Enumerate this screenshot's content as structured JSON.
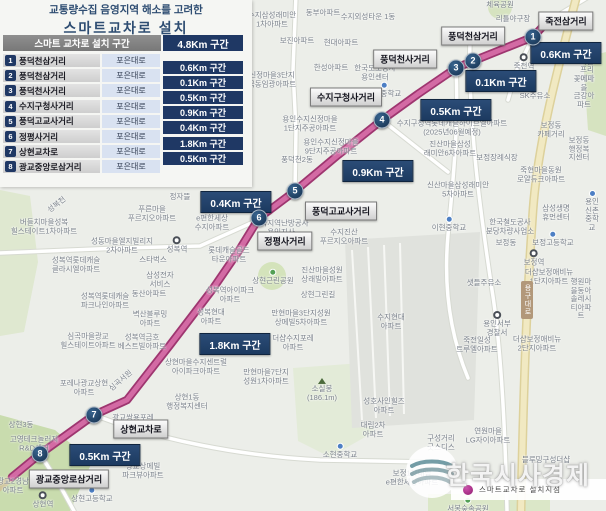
{
  "title": {
    "line1": "교통량수집 음영지역 해소를 고려한",
    "line2": "스마트교차로  설치"
  },
  "table": {
    "header": {
      "label": "스마트 교차로 설치 구간",
      "total": "4.8Km 구간"
    },
    "rows": [
      {
        "no": "1",
        "name": "풍덕천삼거리",
        "road": "포은대로"
      },
      {
        "no": "2",
        "name": "풍덕천삼거리",
        "road": "포은대로"
      },
      {
        "no": "3",
        "name": "풍덕천사거리",
        "road": "포은대로"
      },
      {
        "no": "4",
        "name": "수지구청사거리",
        "road": "포은대로"
      },
      {
        "no": "5",
        "name": "풍덕고교사거리",
        "road": "포은대로"
      },
      {
        "no": "6",
        "name": "정평사거리",
        "road": "포은대로"
      },
      {
        "no": "7",
        "name": "상현교차로",
        "road": "포은대로"
      },
      {
        "no": "8",
        "name": "광교중앙로삼거리",
        "road": "포은대로"
      }
    ],
    "segments": [
      "0.6Km 구간",
      "0.1Km 구간",
      "0.5Km 구간",
      "0.9Km 구간",
      "0.4Km 구간",
      "1.8Km 구간",
      "0.5Km 구간"
    ]
  },
  "map": {
    "route_points": "548,21 533,37 473,61 456,68 418,94 382,120 338,155 295,191 259,218 238,252 212,290 170,345 127,400 94,415 40,454 12,477",
    "markers": [
      {
        "no": "1",
        "x": 533,
        "y": 37
      },
      {
        "no": "2",
        "x": 473,
        "y": 61
      },
      {
        "no": "3",
        "x": 456,
        "y": 68
      },
      {
        "no": "4",
        "x": 382,
        "y": 120
      },
      {
        "no": "5",
        "x": 295,
        "y": 191
      },
      {
        "no": "6",
        "x": 259,
        "y": 218
      },
      {
        "no": "7",
        "x": 94,
        "y": 415
      },
      {
        "no": "8",
        "x": 40,
        "y": 454
      }
    ],
    "intersections": [
      {
        "text": "죽전삼거리",
        "x": 566,
        "y": 21
      },
      {
        "text": "풍덕천삼거리",
        "x": 473,
        "y": 36
      },
      {
        "text": "풍덕천사거리",
        "x": 405,
        "y": 59
      },
      {
        "text": "수지구청사거리",
        "x": 346,
        "y": 97
      },
      {
        "text": "풍덕고교사거리",
        "x": 341,
        "y": 211
      },
      {
        "text": "정평사거리",
        "x": 285,
        "y": 241
      },
      {
        "text": "상현교차로",
        "x": 141,
        "y": 429
      },
      {
        "text": "광교중앙로삼거리",
        "x": 69,
        "y": 479
      }
    ],
    "distance_badges": [
      {
        "text": "0.6Km 구간",
        "x": 566,
        "y": 53
      },
      {
        "text": "0.1Km 구간",
        "x": 501,
        "y": 81
      },
      {
        "text": "0.5Km 구간",
        "x": 456,
        "y": 110
      },
      {
        "text": "0.9Km 구간",
        "x": 378,
        "y": 171
      },
      {
        "text": "0.4Km 구간",
        "x": 236,
        "y": 202
      },
      {
        "text": "1.8Km 구간",
        "x": 235,
        "y": 344
      },
      {
        "text": "0.5Km 구간",
        "x": 105,
        "y": 455
      }
    ],
    "road_ribbon": {
      "text": "용구대로",
      "x": 527,
      "y": 300
    },
    "background_labels": [
      {
        "t": "체육공원",
        "x": 500,
        "y": 5
      },
      {
        "t": "리틀야구장",
        "x": 513,
        "y": 19
      },
      {
        "t": "수지삼성래미안\n1차아파트",
        "x": 272,
        "y": 20
      },
      {
        "t": "동부아파트",
        "x": 323,
        "y": 13
      },
      {
        "t": "수지외성타운 1동",
        "x": 368,
        "y": 17
      },
      {
        "t": "죽전역",
        "x": 524,
        "y": 62,
        "icon": "station"
      },
      {
        "t": "도담마을\n프리에제",
        "x": 587,
        "y": 66
      },
      {
        "t": "꽃메마을\n금강아파트",
        "x": 584,
        "y": 92
      },
      {
        "t": "보진아파트",
        "x": 297,
        "y": 41
      },
      {
        "t": "현대아파트",
        "x": 341,
        "y": 43
      },
      {
        "t": "한성아파트",
        "x": 331,
        "y": 68
      },
      {
        "t": "신정마을3단지\n극동임광아파트",
        "x": 272,
        "y": 80
      },
      {
        "t": "한국도로공사\n용인센터",
        "x": 375,
        "y": 73
      },
      {
        "t": "문정중학교",
        "x": 384,
        "y": 90,
        "icon": "school"
      },
      {
        "t": "SK주유소",
        "x": 535,
        "y": 96
      },
      {
        "t": "수지구청역롯데캐슬하이브엘아파트\n(2025년06월예정)",
        "x": 452,
        "y": 128
      },
      {
        "t": "진산마을삼성\n래미안6차아파트",
        "x": 450,
        "y": 149
      },
      {
        "t": "보정동\n카페거리",
        "x": 551,
        "y": 130
      },
      {
        "t": "보정동\n행정복지센터",
        "x": 579,
        "y": 149
      },
      {
        "t": "보정장례식장",
        "x": 497,
        "y": 158
      },
      {
        "t": "용인수지신정마을\n1단지주공아파트",
        "x": 310,
        "y": 124
      },
      {
        "t": "용인수지신정마을\n9단지주공아파트",
        "x": 331,
        "y": 147
      },
      {
        "t": "풍덕천2동",
        "x": 297,
        "y": 160
      },
      {
        "t": "죽현마을동원\n로얄듀크아파트",
        "x": 541,
        "y": 175
      },
      {
        "t": "신산마을삼성래미안\n5차아파트",
        "x": 458,
        "y": 190
      },
      {
        "t": "이현중학교",
        "x": 449,
        "y": 224,
        "icon": "school"
      },
      {
        "t": "수지진산\n푸르지오아파트",
        "x": 344,
        "y": 237
      },
      {
        "t": "e편한세상\n수지아파트",
        "x": 212,
        "y": 223
      },
      {
        "t": "한국지역난방공사\n용인지사",
        "x": 281,
        "y": 228
      },
      {
        "t": "삼성생명\n휴먼센터",
        "x": 556,
        "y": 213
      },
      {
        "t": "용인신촌\n중학교",
        "x": 592,
        "y": 211,
        "icon": "school"
      },
      {
        "t": "한국철도공사\n분당차량사업소",
        "x": 510,
        "y": 227
      },
      {
        "t": "보정동",
        "x": 506,
        "y": 243
      },
      {
        "t": "보정고등학교",
        "x": 553,
        "y": 239,
        "icon": "school"
      },
      {
        "t": "보정역",
        "x": 534,
        "y": 258,
        "icon": "station"
      },
      {
        "t": "더샵보정애비뉴\n1단지아파트",
        "x": 549,
        "y": 277
      },
      {
        "t": "행원마을동아\n솔레시티아파트",
        "x": 581,
        "y": 299
      },
      {
        "t": "샛들주유소",
        "x": 484,
        "y": 283
      },
      {
        "t": "용인서부\n경찰서",
        "x": 497,
        "y": 324,
        "icon": "station"
      },
      {
        "t": "죽전일성\n트루엘아파트",
        "x": 477,
        "y": 345
      },
      {
        "t": "더샵보정애비뉴\n2단지아파트",
        "x": 537,
        "y": 344
      },
      {
        "t": "수지현대\n아파트",
        "x": 391,
        "y": 322
      },
      {
        "t": "정자뜰",
        "x": 180,
        "y": 197
      },
      {
        "t": "푸른마을\n푸르지오아파트",
        "x": 152,
        "y": 214
      },
      {
        "t": "버들치마을성복\n힐스테이트1차아파트",
        "x": 44,
        "y": 227
      },
      {
        "t": "성동마을엘지빌리지\n2차아파트",
        "x": 122,
        "y": 246
      },
      {
        "t": "성복역",
        "x": 177,
        "y": 245,
        "icon": "station"
      },
      {
        "t": "스타벅스",
        "x": 153,
        "y": 260
      },
      {
        "t": "성복역롯데캐슬\n클라시엘아파트",
        "x": 76,
        "y": 265
      },
      {
        "t": "삼성전자\n서비스",
        "x": 160,
        "y": 280
      },
      {
        "t": "롯데캐슬골드\n타운아파트",
        "x": 229,
        "y": 255
      },
      {
        "t": "동산아파트",
        "x": 149,
        "y": 294
      },
      {
        "t": "성복역롯데캐슬\n파크나인아파트",
        "x": 105,
        "y": 301
      },
      {
        "t": "벽산블루밍\n아파트",
        "x": 150,
        "y": 319
      },
      {
        "t": "성복역금호\n베스트빌아파트",
        "x": 142,
        "y": 342
      },
      {
        "t": "성복역아이파크\n아파트",
        "x": 230,
        "y": 295
      },
      {
        "t": "성복현대\n아파트",
        "x": 211,
        "y": 317
      },
      {
        "t": "만현마을3단지성원\n상메빌5차아파트",
        "x": 301,
        "y": 318
      },
      {
        "t": "더샵수지포레\n아파트",
        "x": 293,
        "y": 343
      },
      {
        "t": "만현마을7단지\n성원1차아파트",
        "x": 266,
        "y": 377
      },
      {
        "t": "진산마을성원\n상래빌아파트",
        "x": 322,
        "y": 275
      },
      {
        "t": "상현근린공원",
        "x": 273,
        "y": 277,
        "icon": "park"
      },
      {
        "t": "상현그린길",
        "x": 318,
        "y": 295
      },
      {
        "t": "상현마을수지센트럴\n아이파크아파트",
        "x": 196,
        "y": 367
      },
      {
        "t": "심곡마을광교\n힐스테이트아파트",
        "x": 88,
        "y": 341
      },
      {
        "t": "포레나광교상현\n아파트",
        "x": 84,
        "y": 388
      },
      {
        "t": "심곡서원",
        "x": 121,
        "y": 381,
        "rot": -40
      },
      {
        "t": "상현1동\n행정복지센터",
        "x": 187,
        "y": 402
      },
      {
        "t": "광교쌍용포레",
        "x": 133,
        "y": 418
      },
      {
        "t": "상현3동",
        "x": 21,
        "y": 425
      },
      {
        "t": "고영테크놀러지\nR&D센터",
        "x": 34,
        "y": 444
      },
      {
        "t": "광교상메빌\n파크뷰아파트",
        "x": 143,
        "y": 471
      },
      {
        "t": "상현역",
        "x": 43,
        "y": 500,
        "icon": "station"
      },
      {
        "t": "상현고등학교",
        "x": 92,
        "y": 495,
        "icon": "school"
      },
      {
        "t": "소실봉\n(186.1m)",
        "x": 322,
        "y": 390,
        "icon": "peak"
      },
      {
        "t": "성호사인힐즈\n아파트",
        "x": 384,
        "y": 406
      },
      {
        "t": "대림2차\n아파트",
        "x": 373,
        "y": 430
      },
      {
        "t": "소현중학교",
        "x": 340,
        "y": 451,
        "icon": "school"
      },
      {
        "t": "구성거리\n굿스디스",
        "x": 441,
        "y": 443
      },
      {
        "t": "보정1차대림\ne편한세상아파트",
        "x": 412,
        "y": 478
      },
      {
        "t": "연원마을\nLG자이아파트",
        "x": 488,
        "y": 436
      },
      {
        "t": "블루밍구성더샵",
        "x": 546,
        "y": 460
      },
      {
        "t": "서봉숲속공원",
        "x": 468,
        "y": 505,
        "icon": "park"
      },
      {
        "t": "광교2경남\n아파트",
        "x": 13,
        "y": 486
      },
      {
        "t": "성복천",
        "x": 57,
        "y": 205,
        "rot": -38
      }
    ],
    "legend": {
      "label": "스마트교차로 설치지점"
    },
    "watermark": {
      "text": "한국시사경제"
    }
  },
  "colors": {
    "accent_navy": "#1f3864",
    "route": "#d36aa4",
    "route_border": "#9e3670",
    "header_gray": "#808080",
    "road_cell": "#d9e2f1",
    "legend_dot": "#a8257f"
  }
}
